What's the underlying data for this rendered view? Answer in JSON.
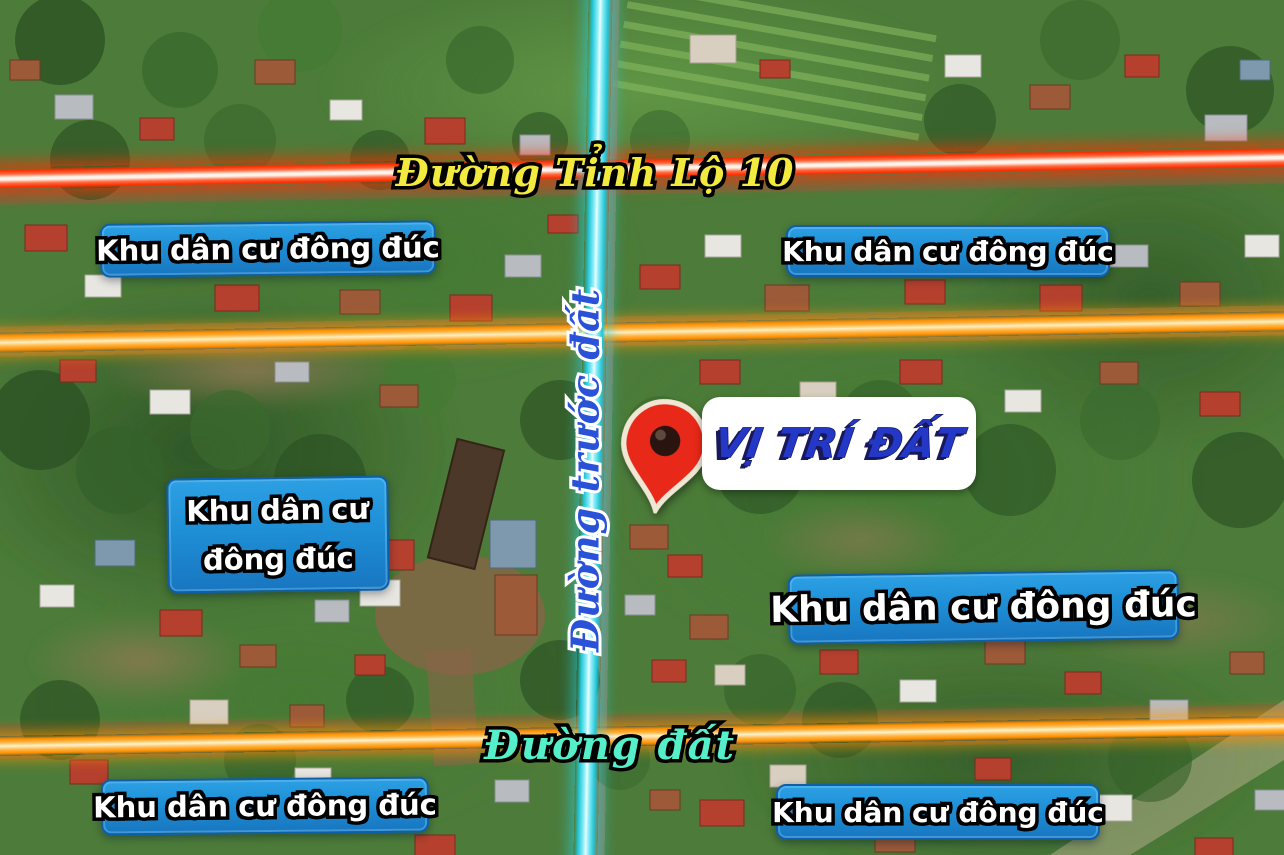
{
  "roads": {
    "highway_label": "Đường Tỉnh Lộ 10",
    "front_road_label": "Đường trước đất",
    "dirt_road_label": "Đường đất"
  },
  "plot": {
    "location_label": "VỊ TRÍ ĐẤT",
    "marker_icon": "red-map-pin"
  },
  "residential_badges": {
    "top_left": "Khu dân cư đông đúc",
    "top_right": "Khu dân cư đông đúc",
    "mid_left_line1": "Khu dân cư",
    "mid_left_line2": "đông đúc",
    "mid_right": "Khu dân cư đông đúc",
    "bottom_left": "Khu dân cư đông đúc",
    "bottom_right": "Khu dân cư đông đúc"
  },
  "colors": {
    "badge_blue": "#1e8fd6",
    "highway_text_yellow": "#f2ea3e",
    "dirt_road_text_aqua": "#55efca",
    "location_text_blue": "#2438c8",
    "front_road_text_blue": "#2a52d8",
    "road_glow_red": "#ff2e00",
    "road_glow_orange": "#ff8e00",
    "road_glow_cyan": "#22c6d8",
    "pin_red": "#e82818"
  }
}
